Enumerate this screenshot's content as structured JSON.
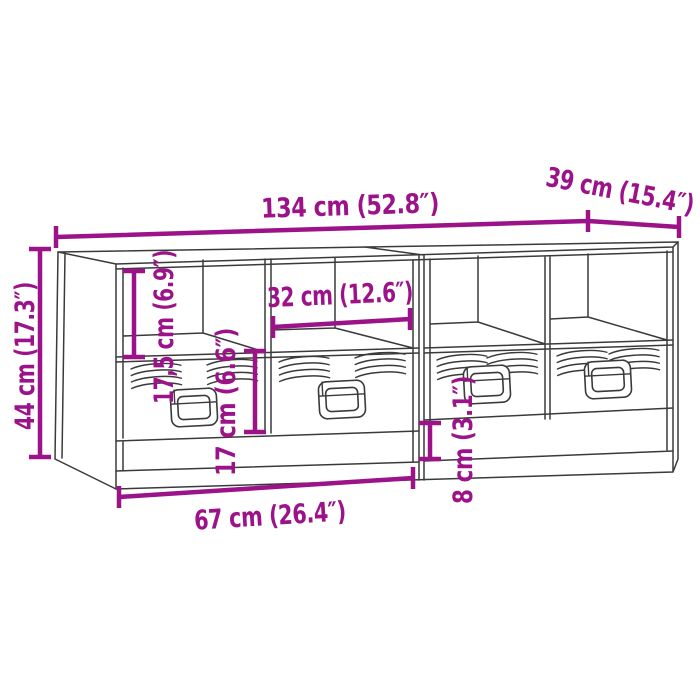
{
  "diagram": {
    "kind": "furniture-dimension-diagram",
    "subject": "TV cabinet set with open compartments and drawers (2 units)",
    "accent_color": "#9c1389",
    "line_color": "#3a3a3a",
    "background_color": "#ffffff",
    "dimensions": {
      "overall_width": {
        "cm": "134",
        "inch": "52.8",
        "label": "134 cm (52.8″)"
      },
      "depth": {
        "cm": "39",
        "inch": "15.4",
        "label": "39 cm (15.4″)"
      },
      "overall_height": {
        "cm": "44",
        "inch": "17.3",
        "label": "44 cm (17.3″)"
      },
      "compartment_height": {
        "cm": "17,5",
        "inch": "6.9",
        "label": "17,5 cm (6.9″)"
      },
      "compartment_width": {
        "cm": "32",
        "inch": "12.6",
        "label": "32 cm (12.6″)"
      },
      "drawer_height": {
        "cm": "17",
        "inch": "6.6",
        "label": "17 cm (6.6″)"
      },
      "bottom_drawer_height": {
        "cm": "8",
        "inch": "3.1",
        "label": "8 cm (3.1″)"
      },
      "unit_width": {
        "cm": "67",
        "inch": "26.4",
        "label": "67 cm (26.4″)"
      }
    }
  }
}
